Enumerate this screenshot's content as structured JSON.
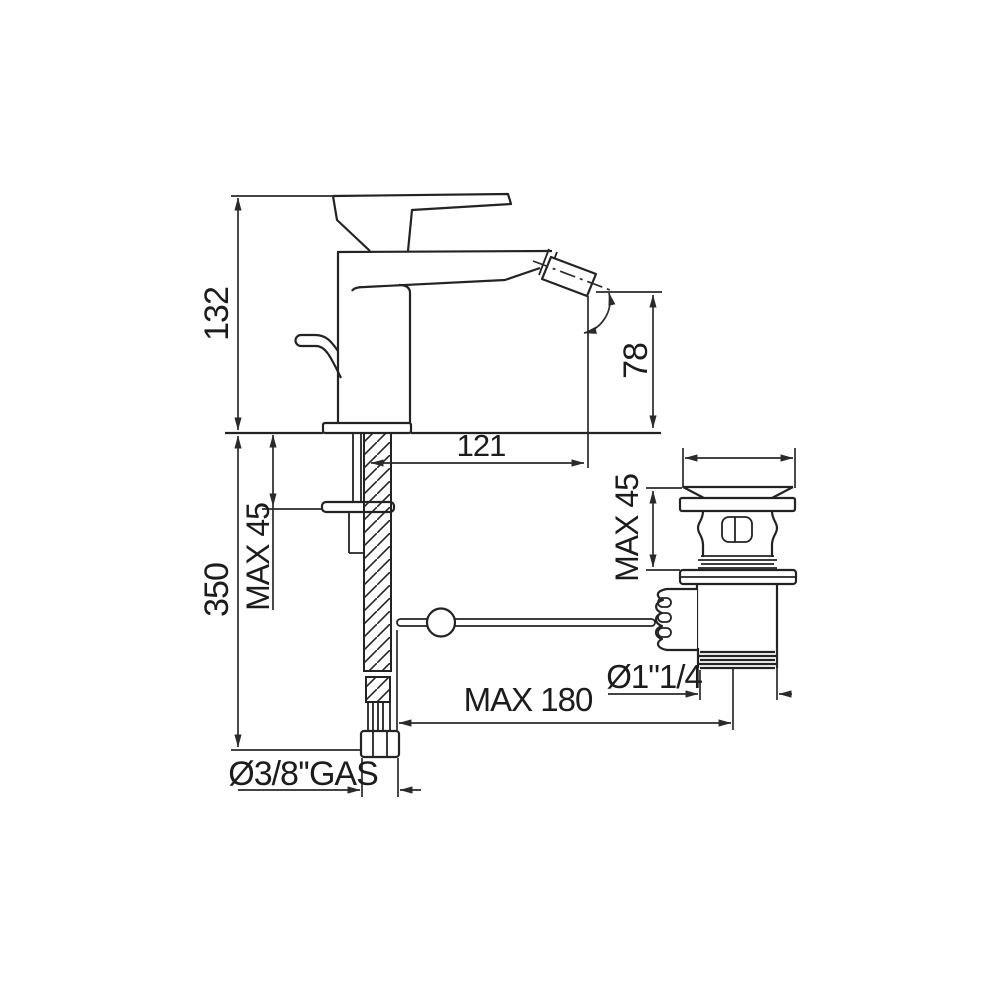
{
  "meta": {
    "drawing_type": "technical-dimension-drawing",
    "background": "#ffffff",
    "line_color": "#232323",
    "text_color": "#1c1c1c"
  },
  "labels": {
    "spout_height": "132",
    "under_deck_height": "350",
    "deck_thickness_max": "MAX 45",
    "outlet_height": "78",
    "spout_reach": "121",
    "waste_deck_max": "MAX 45",
    "waste_thread_diameter": "Ø1\"1/4",
    "rod_length_max": "MAX 180",
    "supply_thread": "Ø3/8''GAS"
  }
}
